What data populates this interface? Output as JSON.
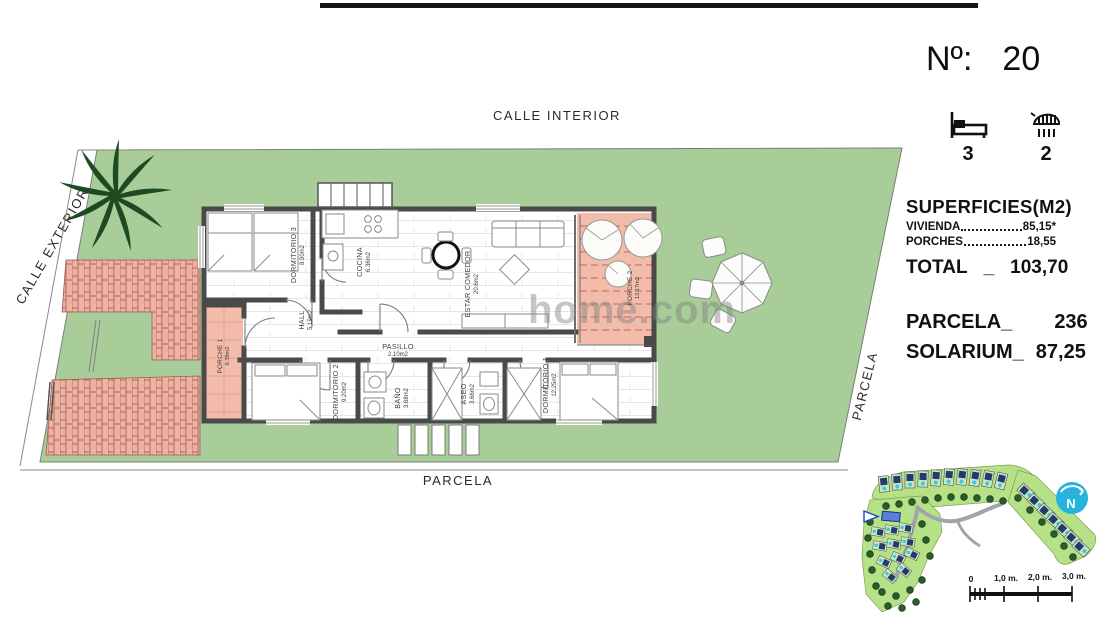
{
  "plan": {
    "labels": {
      "calle_interior": "CALLE INTERIOR",
      "calle_exterior": "CALLE EXTERIOR",
      "parcela_bottom": "PARCELA",
      "parcela_right": "PARCELA"
    },
    "watermark": "home.com",
    "rooms": {
      "dormitorio3": {
        "name": "DORMITORIO 3",
        "area": "8.90m2"
      },
      "cocina": {
        "name": "COCINA",
        "area": "6.36m2"
      },
      "estar": {
        "name": "ESTAR COMEDOR",
        "area": "20.6m2"
      },
      "hall": {
        "name": "HALL",
        "area": "5.19m2"
      },
      "pasillo": {
        "name": "PASILLO",
        "area": "2.10m2"
      },
      "dormitorio2": {
        "name": "DORMITORIO 2",
        "area": "9.20m2"
      },
      "bano": {
        "name": "BAÑO",
        "area": "3.68m2"
      },
      "aseo": {
        "name": "ASEO",
        "area": "3.66m2"
      },
      "dormitorio1": {
        "name": "DORMITORIO 1",
        "area": "12.25m2"
      },
      "porche1": {
        "name": "PORCHE 1",
        "area": "6.38m2"
      },
      "porche2": {
        "name": "PORCHE 2",
        "area": "12.17m2"
      }
    }
  },
  "info_panel": {
    "number_label": "Nº:",
    "number_value": "20",
    "bedrooms": "3",
    "bathrooms": "2",
    "surfaces_title": "SUPERFICIES(M2)",
    "rows": [
      {
        "label": "VIVIENDA",
        "value": "85,15*"
      },
      {
        "label": "PORCHES",
        "value": "18,55"
      }
    ],
    "total_label": "TOTAL",
    "total_sep": "_",
    "total_value": "103,70",
    "parcela_label": "PARCELA_",
    "parcela_value": "236",
    "solarium_label": "SOLARIUM_",
    "solarium_value": "87,25"
  },
  "minimap": {
    "north_label": "N",
    "scale_labels": [
      "0",
      "1,0 m.",
      "2,0 m.",
      "3,0 m."
    ]
  },
  "colors": {
    "parcel_green": "#a8cd99",
    "porch_salmon": "#f3bba9",
    "brick": "#ecb2a4",
    "wall": "#4a4a4a",
    "pool_cyan": "#38c9ea",
    "north_cyan": "#25b3de",
    "marker_blue": "#5b7fd6"
  }
}
